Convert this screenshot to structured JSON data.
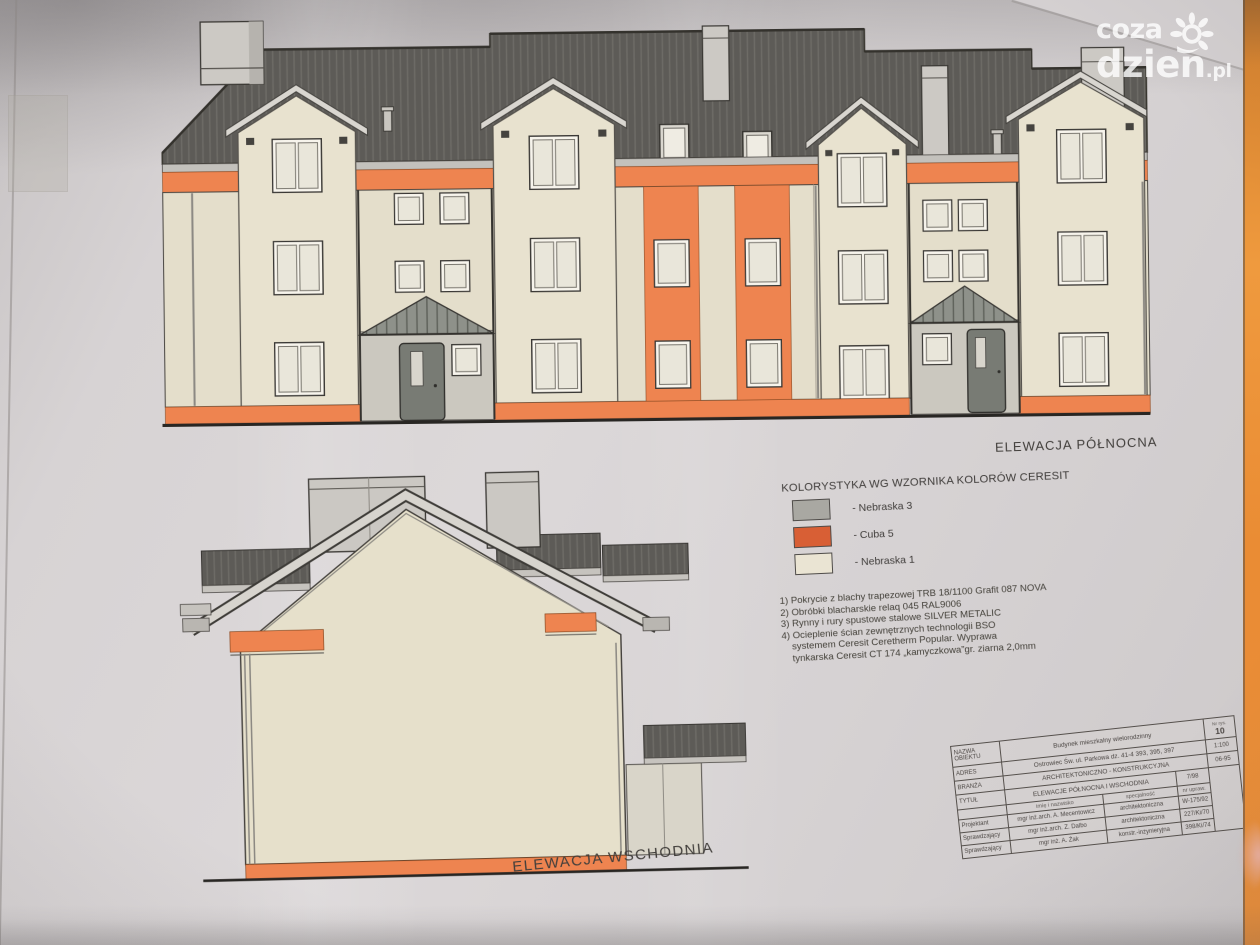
{
  "watermark": {
    "line1": "coza",
    "line2": "dzien",
    "suffix": ".pl"
  },
  "drawing": {
    "north_label": "ELEWACJA PÓŁNOCNA",
    "east_label": "ELEWACJA WSCHODNIA"
  },
  "legend": {
    "title": "KOLORYSTYKA WG WZORNIKA KOLORÓW CERESIT",
    "items": [
      {
        "label": "- Nebraska 3",
        "color": "#a9a8a2"
      },
      {
        "label": "- Cuba 5",
        "color": "#d85f35"
      },
      {
        "label": "- Nebraska 1",
        "color": "#eae4d3"
      }
    ]
  },
  "notes": [
    "1) Pokrycie z blachy trapezowej TRB 18/1100 Grafit 087 NOVA",
    "2) Obróbki blacharskie relaq 045  RAL9006",
    "3) Rynny i rury spustowe stalowe SILVER METALIC",
    "4) Ocieplenie ścian zewnętrznych technologii BSO",
    "systemem  Ceresit Ceretherm Popular. Wyprawa",
    "tynkarska Ceresit CT 174 „kamyczkowa”gr. ziarna 2,0mm"
  ],
  "titleblock": {
    "rows": [
      {
        "label": "NAZWA OBIEKTU",
        "value": "Budynek mieszkalny wielorodzinny"
      },
      {
        "label": "ADRES",
        "value": "Ostrowiec Św. ul. Parkowa  dz. 41-4 393, 395, 397"
      },
      {
        "label": "BRANŻA",
        "value": "ARCHITEKTONICZNO - KONSTRUKCYJNA"
      },
      {
        "label": "TYTUŁ",
        "value": "ELEWACJE PÓŁNOCNA I WSCHODNIA",
        "extra": "7/98"
      }
    ],
    "header": {
      "name": "imię i nazwisko",
      "spec": "specjalność",
      "cert": "nr upraw."
    },
    "people": [
      {
        "role": "Projektant",
        "name": "mgr inż.arch. A. Mecentowicz",
        "spec": "architektoniczna",
        "cert": "W-175/92"
      },
      {
        "role": "Sprawdzający",
        "name": "mgr inż.arch. Z. Dalbo",
        "spec": "architektoniczna",
        "cert": "227/Ki/70"
      },
      {
        "role": "Sprawdzający",
        "name": "mgr inż. A. Żak",
        "spec": "konstr.-inżynieryjna",
        "cert": "398/Ki/74"
      }
    ],
    "corner": {
      "no_label": "Nr rys.",
      "no": "10",
      "scale": "1:100",
      "date": "06-95"
    }
  },
  "colors": {
    "roof": "#5d5b57",
    "wall": "#e4decb",
    "accent_orange": "#ee8450",
    "paper": "#d7d3d4"
  }
}
